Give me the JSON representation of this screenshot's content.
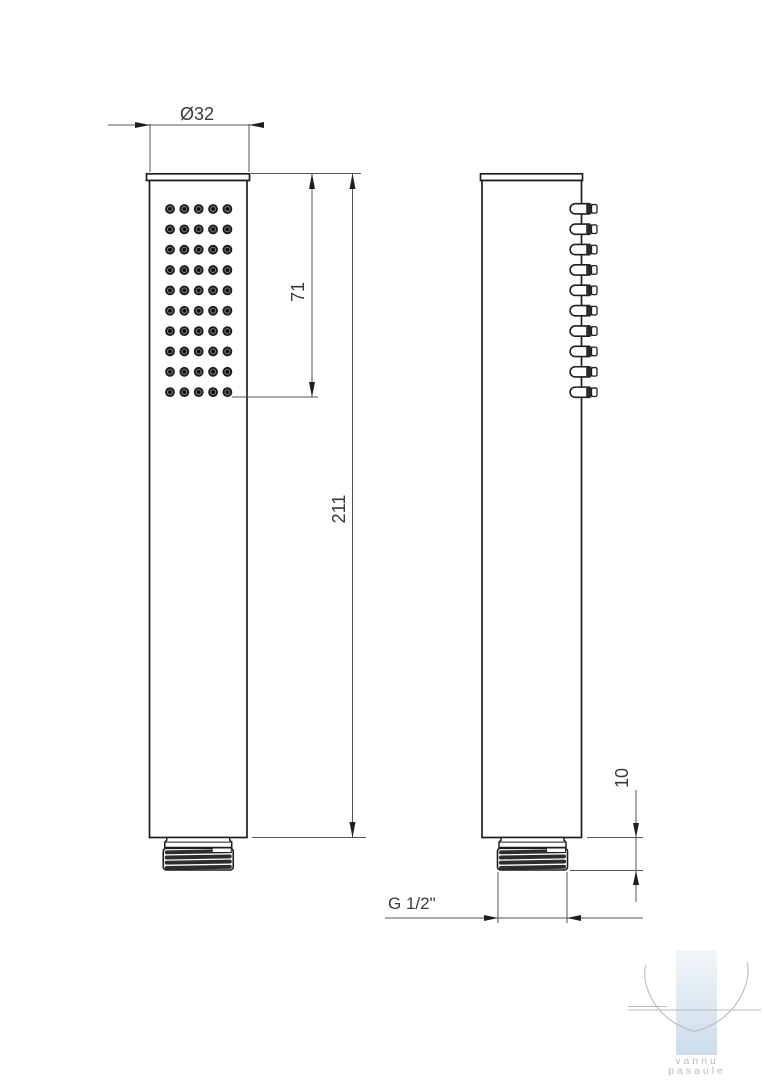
{
  "page": {
    "background": "#ffffff"
  },
  "drawing": {
    "type": "technical-drawing-2-views-shower-handset",
    "dimensions": {
      "diameter_label": "Ø32",
      "spray_face_length_label": "71",
      "total_length_label": "211",
      "thread_length_label": "10",
      "thread_spec_label": "G 1/2\""
    },
    "spray_grid": {
      "columns": 5,
      "rows": 10
    },
    "side_nozzle_count": 10,
    "colors": {
      "outline": "#1e1e1e",
      "dimension_line": "#555555",
      "dimension_text": "#3a3a3a",
      "watermark_blue_top": "#f1f6fa",
      "watermark_blue_bottom": "#ccdcea",
      "watermark_gray": "#b6bcc3"
    }
  },
  "watermark": {
    "line1": "vannu",
    "line2": "pasaule"
  }
}
